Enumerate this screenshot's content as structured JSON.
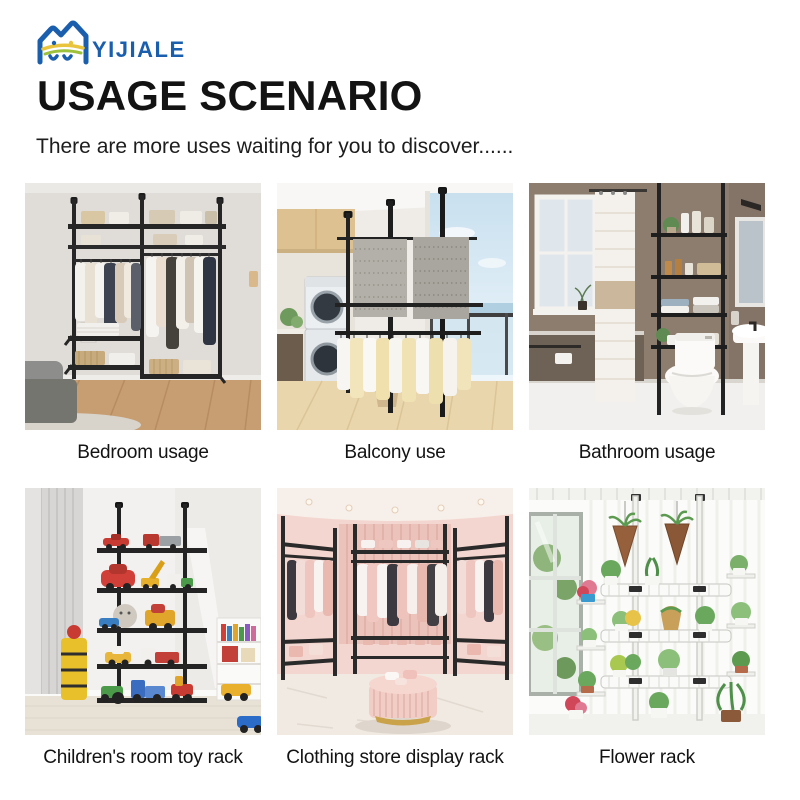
{
  "brand": {
    "name": "YIJIALE",
    "logo_blue": "#1a5fae",
    "logo_yellow": "#e9c53e",
    "logo_green": "#9ec13b"
  },
  "header": {
    "title": "USAGE SCENARIO",
    "subtitle": "There are more uses waiting for you to discover......"
  },
  "scenarios": [
    {
      "scene": "bedroom",
      "caption": "Bedroom usage"
    },
    {
      "scene": "balcony",
      "caption": "Balcony use"
    },
    {
      "scene": "bathroom",
      "caption": "Bathroom usage"
    },
    {
      "scene": "children-room",
      "caption": "Children's room toy rack"
    },
    {
      "scene": "clothing-store",
      "caption": "Clothing store display rack"
    },
    {
      "scene": "flower",
      "caption": "Flower rack"
    }
  ]
}
